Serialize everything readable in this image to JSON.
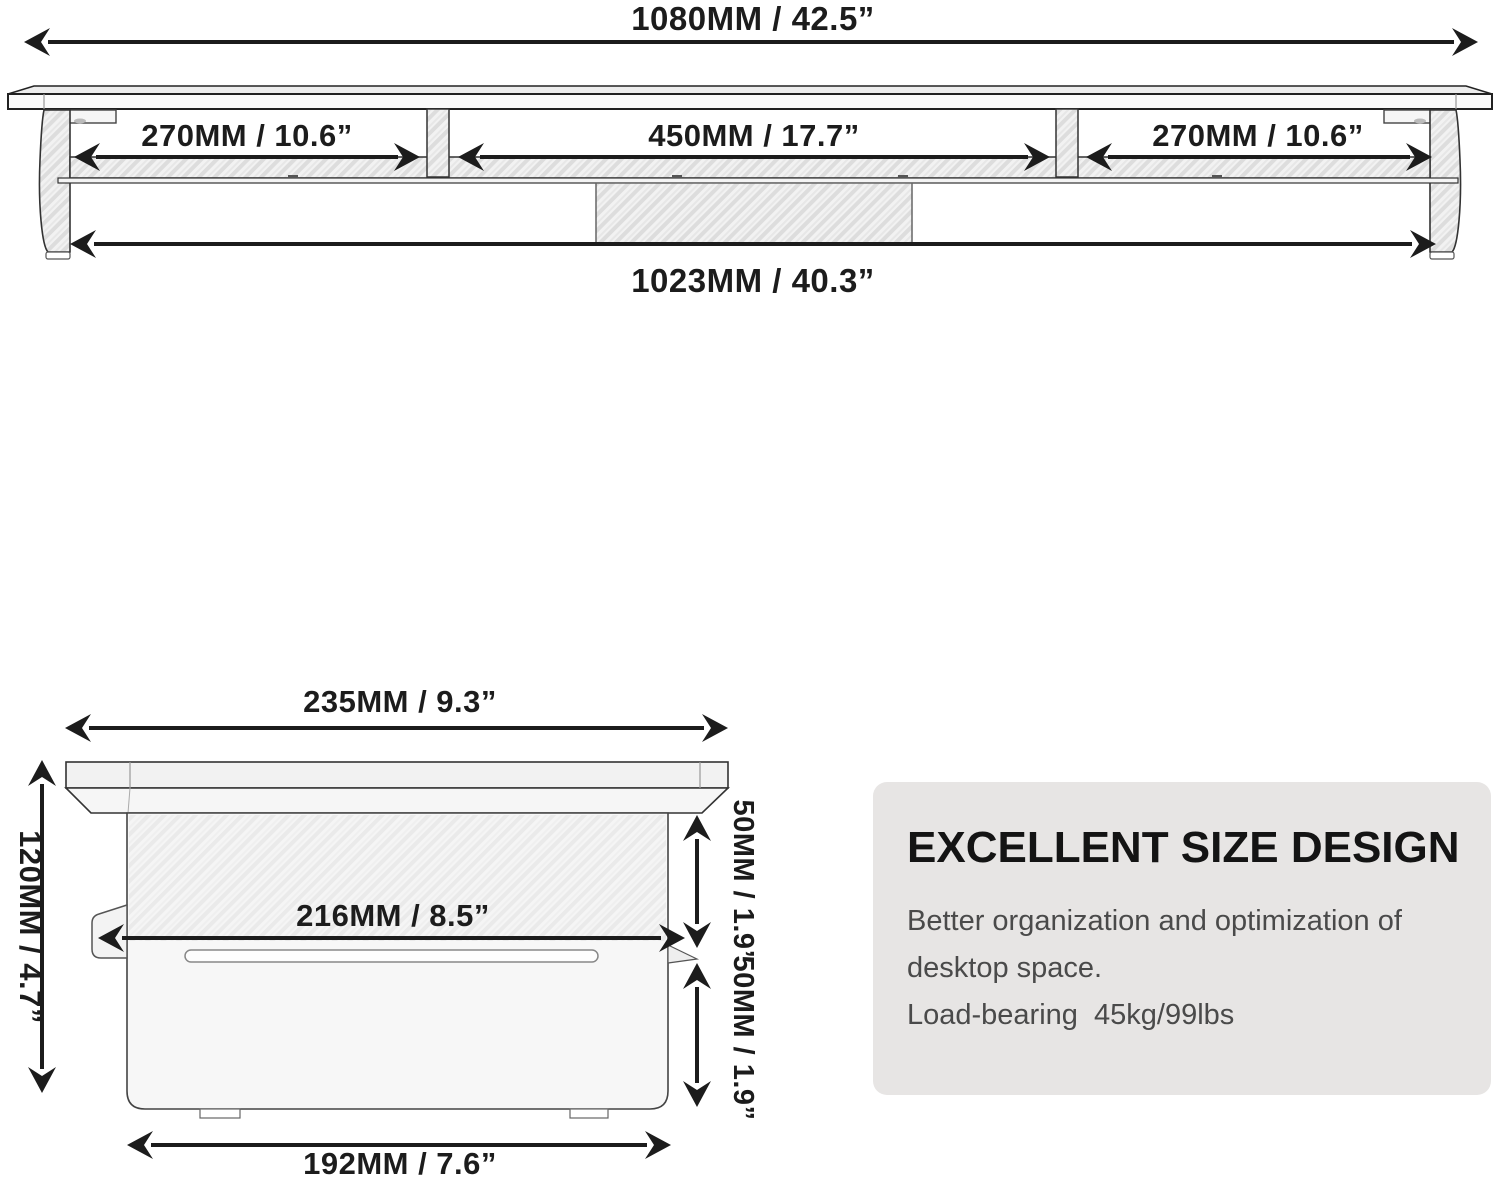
{
  "top_view": {
    "total_width": "1080MM / 42.5”",
    "left_section": "270MM / 10.6”",
    "middle_section": "450MM / 17.7”",
    "right_section": "270MM / 10.6”",
    "inner_width": "1023MM / 40.3”"
  },
  "side_view": {
    "top_width": "235MM / 9.3”",
    "height": "120MM / 4.7”",
    "middle_width": "216MM / 8.5”",
    "upper_gap": "50MM / 1.9”",
    "lower_gap": "50MM / 1.9”",
    "bottom_width": "192MM / 7.6”"
  },
  "info_card": {
    "title": "EXCELLENT SIZE DESIGN",
    "body_line1": "Better organization and optimization of",
    "body_line2": "desktop space.",
    "body_line3": "Load-bearing  45kg/99lbs"
  },
  "colors": {
    "card_bg": "#e7e5e4",
    "line_color": "#1c1c1c",
    "body_text": "#4a4a4a"
  }
}
